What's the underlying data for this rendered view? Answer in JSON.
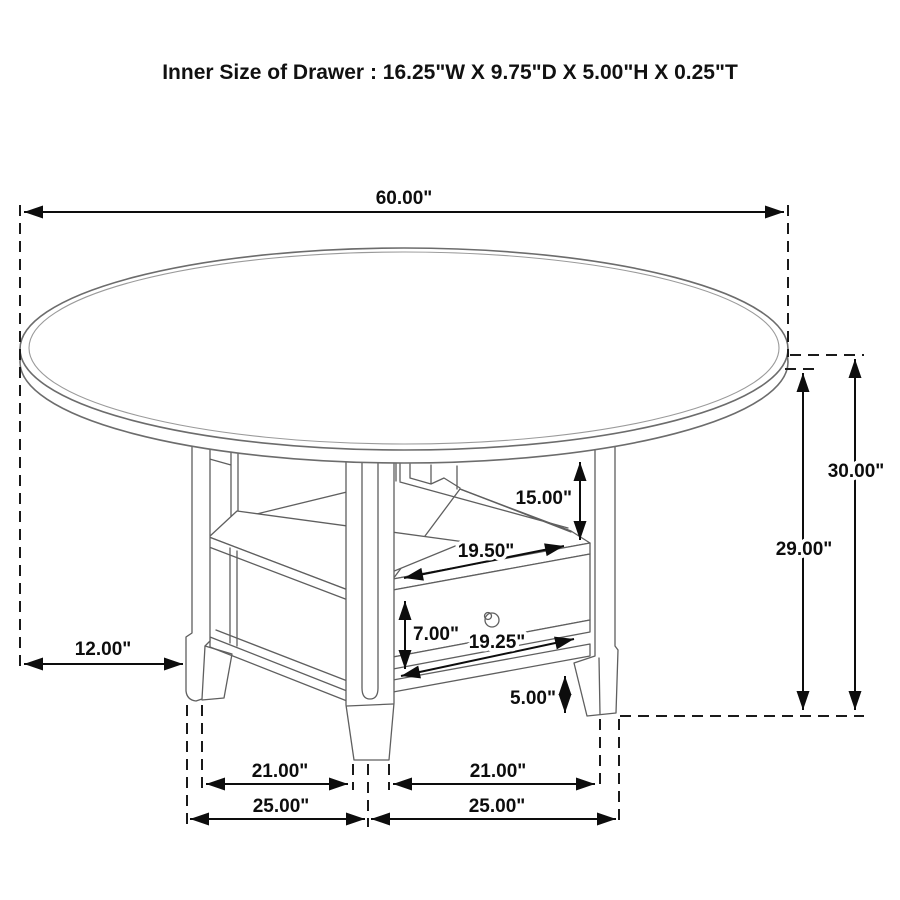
{
  "title": "Inner Size of Drawer : 16.25\"W X 9.75\"D X 5.00\"H X 0.25\"T",
  "diagram": {
    "type": "furniture-dimension-line-drawing",
    "subject": "60 inch round dining table with pedestal storage base, open shelves and one drawer",
    "style": {
      "background": "#ffffff",
      "drawing_line_color": "#5f5f5f",
      "dimension_line_color": "#0d0d0d",
      "text_color": "#0d0d0d"
    }
  },
  "dimensions": {
    "top_diameter": {
      "label": "60.00\"",
      "meaning": "table top diameter"
    },
    "top_overhang": {
      "label": "12.00\"",
      "meaning": "top overhang from edge to leg"
    },
    "overall_height": {
      "label": "30.00\"",
      "meaning": "floor to top surface"
    },
    "height_under_top": {
      "label": "29.00\"",
      "meaning": "floor to underside of top"
    },
    "open_section_height": {
      "label": "15.00\"",
      "meaning": "underside of top to shelf"
    },
    "shelf_opening_width": {
      "label": "19.50\"",
      "meaning": "shelf front width"
    },
    "drawer_front_height": {
      "label": "7.00\"",
      "meaning": "drawer front height"
    },
    "drawer_front_width": {
      "label": "19.25\"",
      "meaning": "drawer front width"
    },
    "bottom_clearance": {
      "label": "5.00\"",
      "meaning": "bottom shelf to floor"
    },
    "left_inner_span": {
      "label": "21.00\"",
      "meaning": "inner leg span, left bay"
    },
    "right_inner_span": {
      "label": "21.00\"",
      "meaning": "inner leg span, right bay"
    },
    "left_outer_span": {
      "label": "25.00\"",
      "meaning": "outer leg span, left bay"
    },
    "right_outer_span": {
      "label": "25.00\"",
      "meaning": "outer leg span, right bay"
    }
  }
}
